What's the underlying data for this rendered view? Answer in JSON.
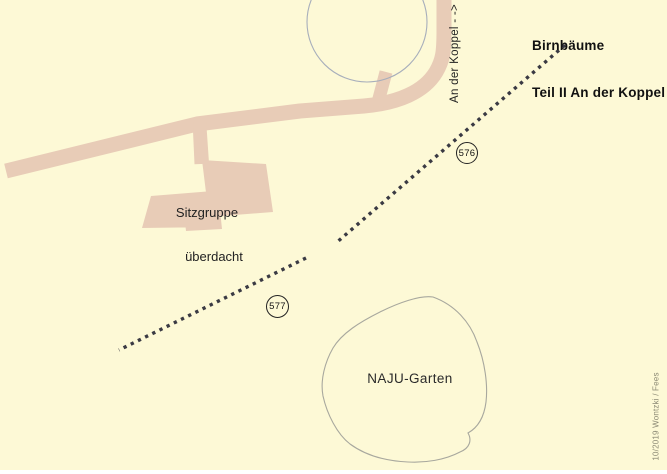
{
  "header": {
    "title_line1": "Birnbäume",
    "title_line2": "Teil II An der Koppel"
  },
  "labels": {
    "street": "An der Koppel - ->",
    "shelter_line1": "Sitzgruppe",
    "shelter_line2": "überdacht",
    "garden": "NAJU-Garten",
    "credit": "10/2019 Wontzki / Fees"
  },
  "markers": [
    {
      "label": "576"
    },
    {
      "label": "577"
    }
  ],
  "colors": {
    "background": "#fdf9d6",
    "road": "#e8ccb7",
    "trail": "#3a3a43",
    "tree_outline": "#a7aebb",
    "garden_outline": "#a8a89e",
    "text": "#111111",
    "credit_text": "#8b8974"
  }
}
